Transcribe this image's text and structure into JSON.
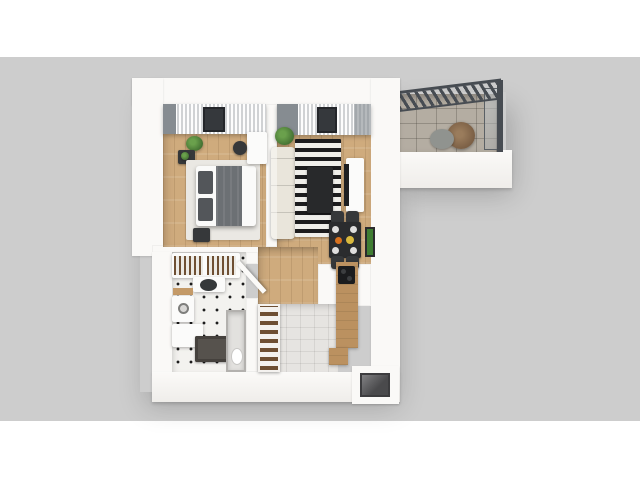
{
  "scene": {
    "type": "3d-apartment-floor-plan-top-view",
    "rooms": [
      {
        "name": "bedroom",
        "furniture": [
          "window-blinds",
          "corner-plant",
          "nightstand",
          "nightstand",
          "double-bed",
          "pillows",
          "blanket",
          "area-rug",
          "desk",
          "desk-chair"
        ]
      },
      {
        "name": "living-room",
        "furniture": [
          "window-blinds",
          "sofa",
          "sofa-plant",
          "striped-rug",
          "coffee-table",
          "tv-sideboard",
          "tv",
          "dining-table",
          "dining-chair",
          "dining-chair",
          "dining-chair",
          "dining-chair",
          "plates",
          "wall-art"
        ]
      },
      {
        "name": "bathroom",
        "furniture": [
          "wardrobe-with-hangers",
          "washbasin",
          "washing-machine",
          "wood-shelf",
          "vanity-cabinet",
          "dark-counter-tub",
          "shower-cabin",
          "toilet",
          "open-door"
        ]
      },
      {
        "name": "kitchen-hall",
        "furniture": [
          "tall-storage-shelf",
          "kitchen-counter",
          "cooktop",
          "wood-shelf"
        ]
      },
      {
        "name": "balcony",
        "furniture": [
          "metal-railing",
          "glass-panel",
          "stone-tile-floor",
          "wicker-lounge-chair",
          "blanket"
        ]
      }
    ],
    "structure": [
      "outer-walls",
      "room-divider-wall",
      "bottom-slab",
      "vent-column"
    ]
  },
  "palette": {
    "band": "#cdcdcd",
    "wall": "#faf9f7",
    "wood": "#cfab7d",
    "wood2": "#bb9160",
    "ruglight": "#eae8e3",
    "rugdark": "#1c1c1e",
    "ruglt2": "#efeeea",
    "sofa": "#e9e5db",
    "dark": "#36383a",
    "bed": "#fafaf9",
    "blanket": "#6c7074",
    "pillow": "#53565a",
    "plant": "#426f31",
    "plantlt": "#6aa04c",
    "blindlight": "#d0d2d4",
    "blinddark": "#868c91",
    "window": "#35383c",
    "bathtile": "#f3f2ef",
    "dot": "#1d1d1d",
    "kitchentile": "#e6e4e1",
    "cooktop": "#1b1c1e",
    "shelfbrown": "#6e4f33",
    "stone": "#b4ada2",
    "railing": "#474c52",
    "tv": "#1e1f21",
    "art": "#3f7d32",
    "orange": "#d8721f",
    "yellow": "#d9b93e",
    "tub": "#56524d",
    "wicker": "#7b5f45",
    "throw": "#90938f"
  }
}
